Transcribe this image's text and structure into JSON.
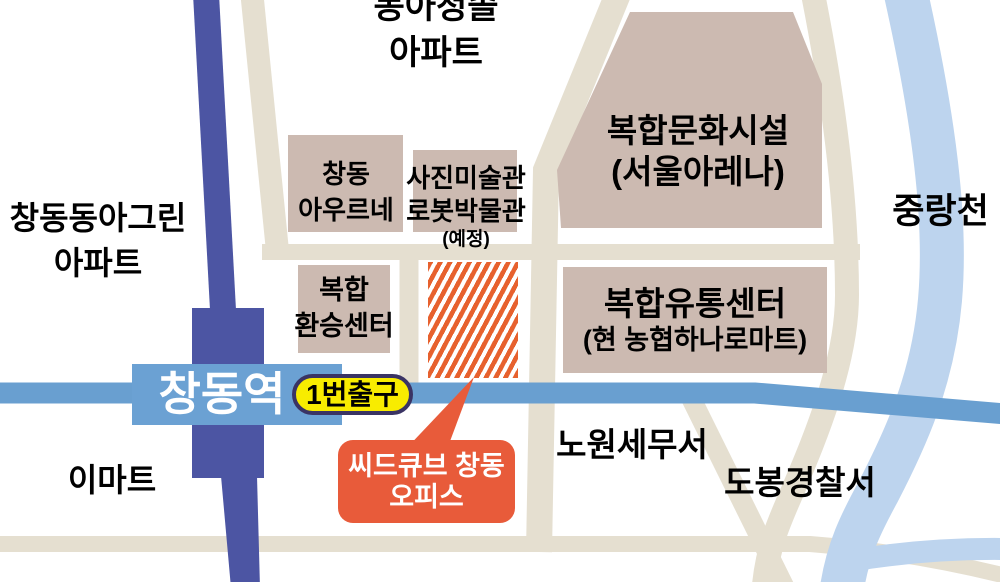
{
  "labels": {
    "donga_cheongsol": {
      "line1": "동아청솔",
      "line2": "아파트"
    },
    "changdong_donga_green": {
      "line1": "창동동아그린",
      "line2": "아파트"
    },
    "jungnangcheon": "중랑천",
    "auruene": {
      "line1": "창동",
      "line2": "아우르네"
    },
    "museum": {
      "line1": "사진미술관",
      "line2": "로봇박물관",
      "line3": "(예정)"
    },
    "arena": {
      "line1": "복합문화시설",
      "line2": "(서울아레나)"
    },
    "transfer_center": {
      "line1": "복합",
      "line2": "환승센터"
    },
    "distribution_center": {
      "line1": "복합유통센터",
      "line2": "(현 농협하나로마트)"
    },
    "station": "창동역",
    "exit1": "1번출구",
    "emart": "이마트",
    "nowon_tax_office": "노원세무서",
    "dobong_police": "도봉경찰서",
    "seedcube": {
      "line1": "씨드큐브 창동",
      "line2": "오피스"
    }
  },
  "colors": {
    "railway": "#4c55a3",
    "railline": "#699fd0",
    "stationbox": "#6ba1d3",
    "stream": "#bdd4ee",
    "road": "#e5dfd0",
    "building": "#ccbab1",
    "hatch": "#e7612e",
    "bubble": "#e85b3a",
    "yellow": "#f8ec00",
    "pillborder": "#3a3464",
    "ink": "#000000",
    "stationtext": "#ffffff"
  }
}
